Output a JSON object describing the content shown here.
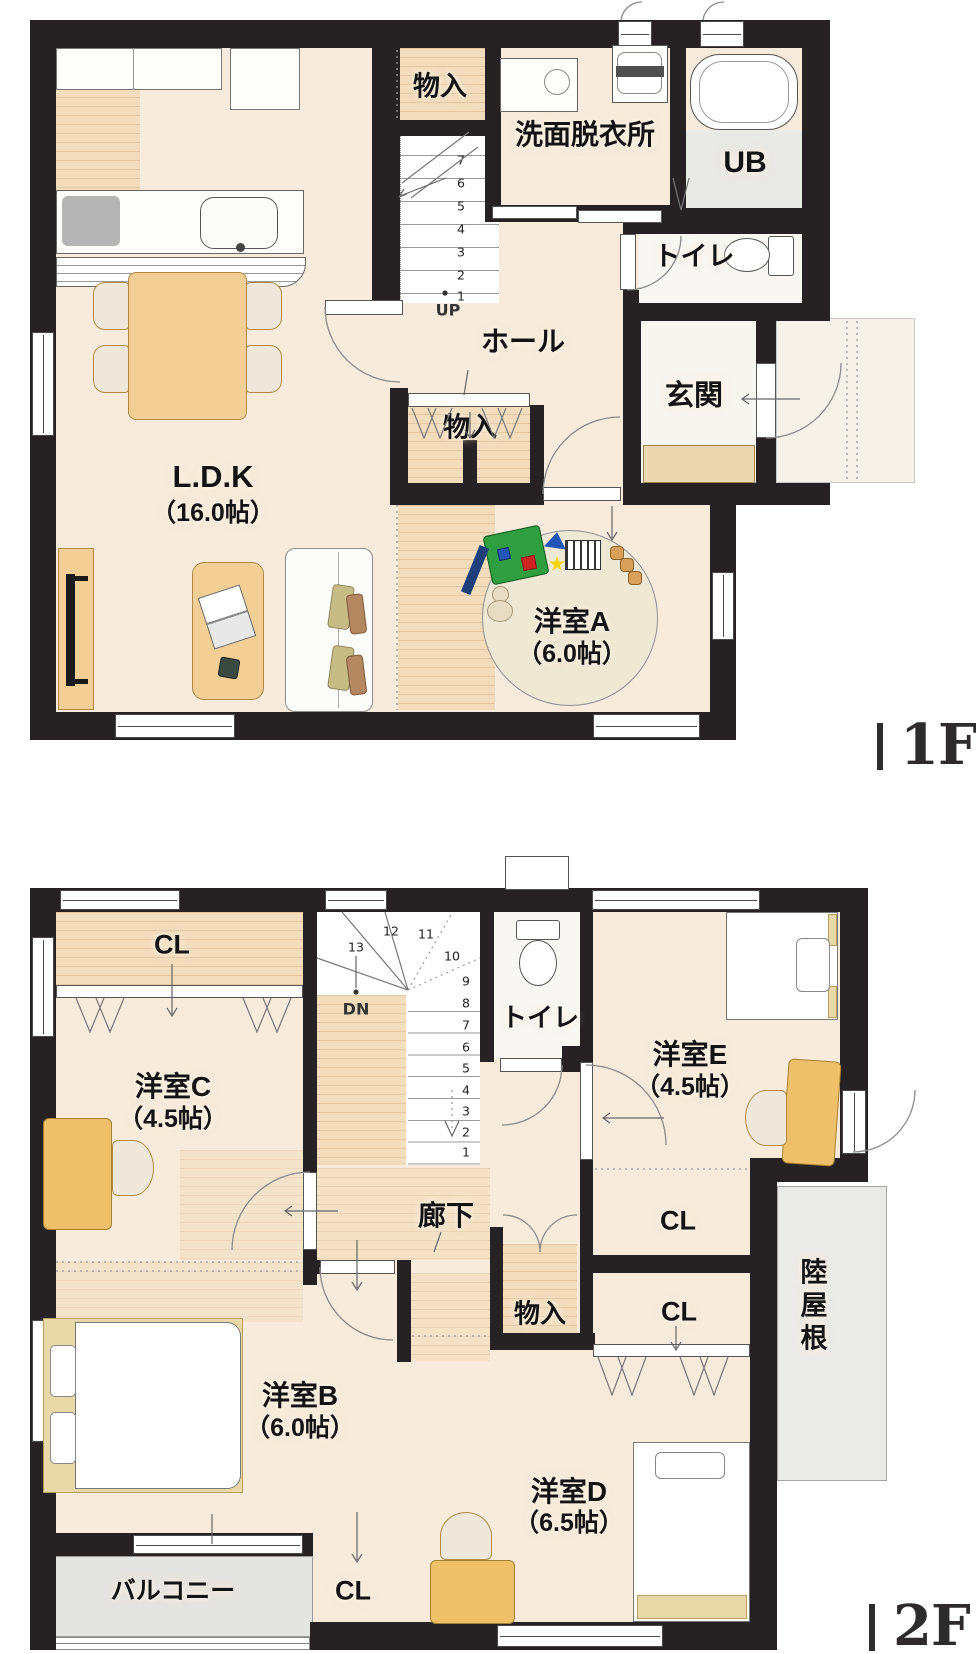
{
  "palette": {
    "wall": "#262223",
    "floor_cream": "#f8ebdb",
    "wood": "#f2dcbc",
    "furniture_tan": "#f3cf96",
    "desk_yellow": "#efc06a",
    "gray_floor": "#e9e9e6",
    "balcony_gray": "#e4e4e2",
    "toy_green": "#2f9e41",
    "toy_blue": "#2256b8",
    "toy_yellow": "#f5d400",
    "label_color": "#131313"
  },
  "floor1": {
    "floor_tag": "1F",
    "rooms": {
      "monoire_top": "物入",
      "senmen": "洗面脱衣所",
      "ub": "UB",
      "toilet": "トイレ",
      "hall": "ホール",
      "genkan": "玄関",
      "monoire_mid": "物入",
      "ldk_name": "L.D.K",
      "ldk_size": "（16.0帖）",
      "room_a_name": "洋室A",
      "room_a_size": "（6.0帖）"
    },
    "stairs": {
      "up_label": "UP",
      "numbers": [
        "1",
        "2",
        "3",
        "4",
        "5",
        "6",
        "7"
      ]
    }
  },
  "floor2": {
    "floor_tag": "2F",
    "rooms": {
      "cl_c": "CL",
      "room_c_name": "洋室C",
      "room_c_size": "（4.5帖）",
      "toilet": "トイレ",
      "room_e_name": "洋室E",
      "room_e_size": "（4.5帖）",
      "rouka": "廊下",
      "cl_mid_upper": "CL",
      "cl_mid_lower": "CL",
      "monoire": "物入",
      "rikuyane": "陸屋根",
      "room_b_name": "洋室B",
      "room_b_size": "（6.0帖）",
      "balcony": "バルコニー",
      "cl_b": "CL",
      "room_d_name": "洋室D",
      "room_d_size": "（6.5帖）"
    },
    "stairs": {
      "dn_label": "DN",
      "numbers": [
        "1",
        "2",
        "3",
        "4",
        "5",
        "6",
        "7",
        "8",
        "9",
        "10",
        "11",
        "12",
        "13"
      ]
    }
  }
}
